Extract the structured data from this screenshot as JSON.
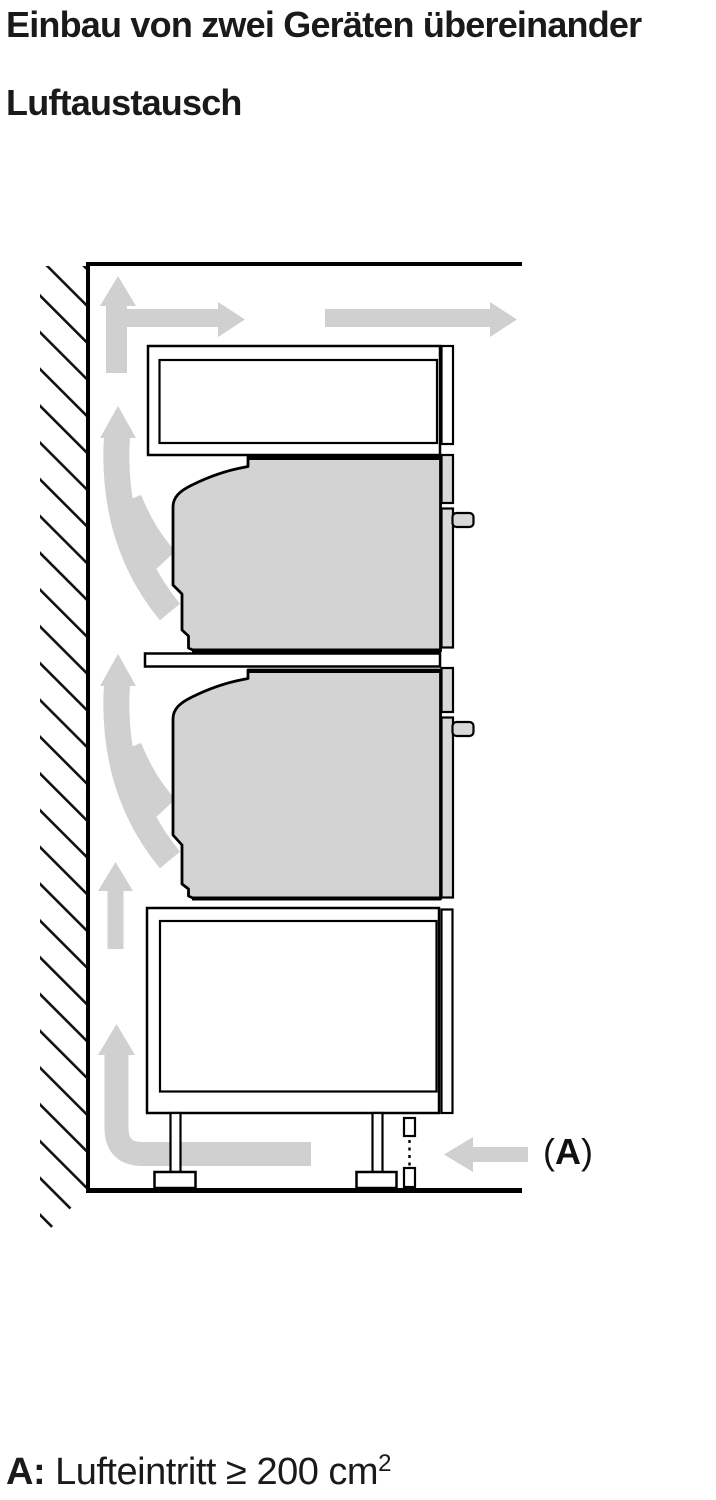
{
  "header": {
    "title": "Einbau von zwei Geräten übereinander",
    "subtitle": "Luftaustausch"
  },
  "diagram": {
    "label_a": {
      "open": "(",
      "letter": "A",
      "close": ")"
    },
    "colors": {
      "arrow": "#d0d0d0",
      "appliance": "#d3d3d3",
      "trim": "#d8d8d8",
      "outline": "#000000",
      "background": "#ffffff"
    }
  },
  "caption": {
    "prefix": "A:",
    "body": "Lufteintritt ≥ 200 cm",
    "superscript": "2"
  }
}
